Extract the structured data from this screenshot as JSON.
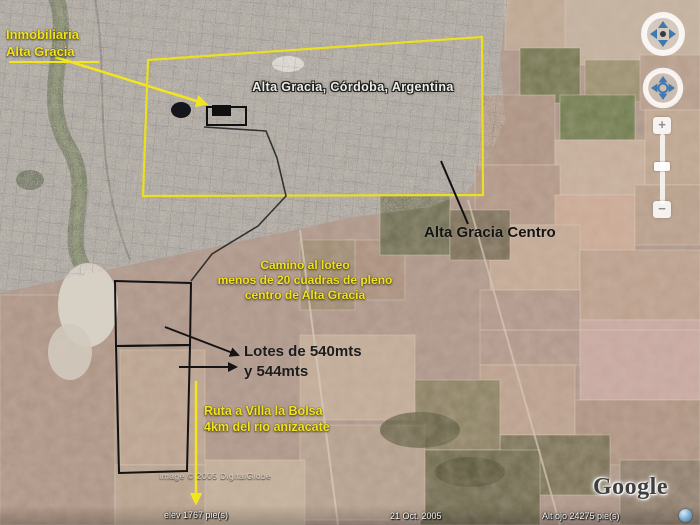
{
  "annotations": {
    "inmobiliaria": {
      "line1": "Inmobiliaria",
      "line2": "Alta Gracia"
    },
    "city_label": "Alta Gracia,  Córdoba,  Argentina",
    "centro_label": "Alta Gracia Centro",
    "camino": {
      "line1": "Camino al loteo",
      "line2": "menos de 20 cuadras de pleno",
      "line3": "centro de Alta Gracia"
    },
    "lotes": {
      "line1": "Lotes de 540mts",
      "line2": "y 544mts"
    },
    "ruta": {
      "line1": "Ruta a Villa la Bolsa",
      "line2": "4km del rio anizacate"
    }
  },
  "watermark": "Image © 2005 DigitalGlobe",
  "logo_text": "Google",
  "status_bar": {
    "elevation": "elev   1767 pie(s)",
    "date": "21 Oct. 2005",
    "eye_altitude": "Alt ojo   24275 pie(s)"
  },
  "nav": {
    "zoom_in": "+",
    "zoom_out": "−"
  },
  "colors": {
    "annotation_yellow": "#f2e51c",
    "annotation_black": "#141414",
    "label_white": "#efefe9",
    "nav_blue": "#3e7ab2"
  }
}
